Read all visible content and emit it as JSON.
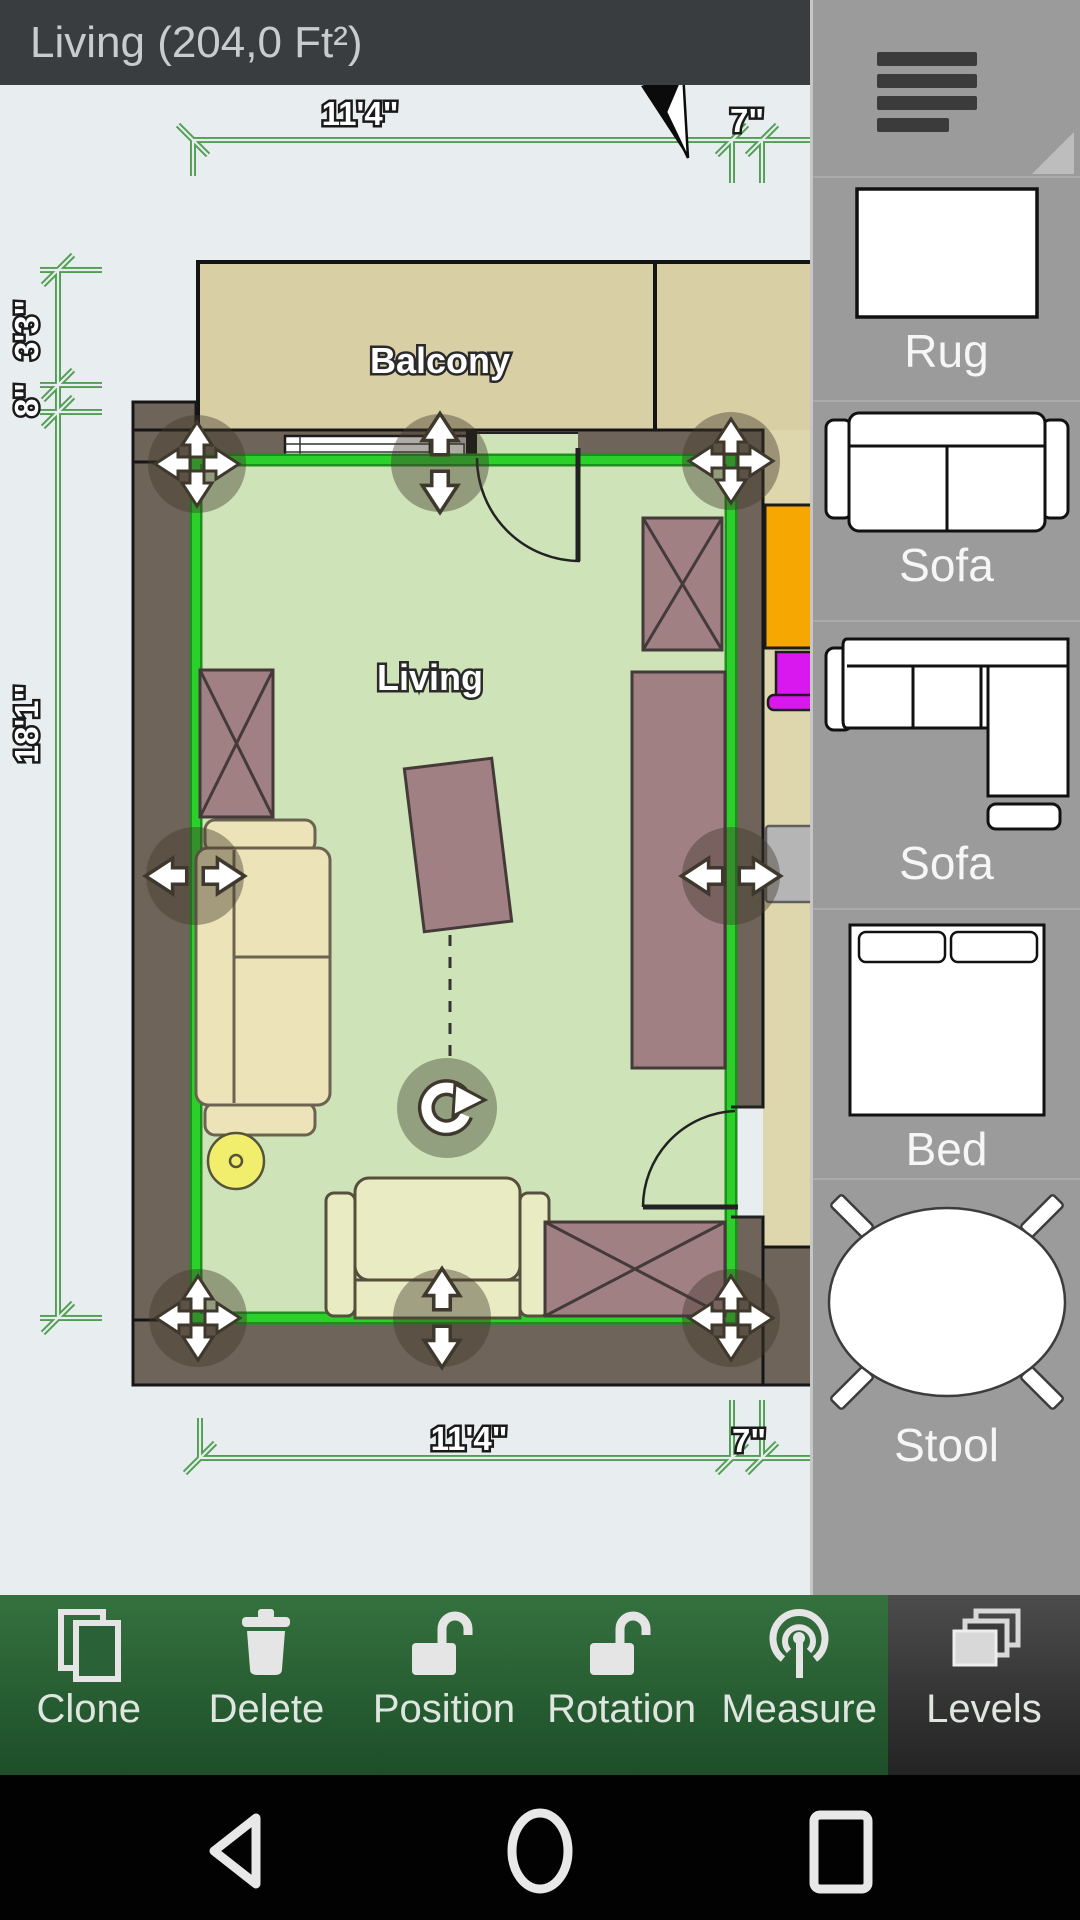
{
  "title_bar": {
    "title": "Living (204,0 Ft²)"
  },
  "plan": {
    "room_label": "Living",
    "balcony_label": "Balcony",
    "dimensions": {
      "top_width": "11'4\"",
      "top_offset": "7\"",
      "bottom_width": "11'4\"",
      "bottom_offset": "7\"",
      "left_balcony": "3'3\"",
      "left_wall": "8\"",
      "left_height": "18'1\""
    }
  },
  "sidebar": {
    "items": [
      {
        "label": "Rug"
      },
      {
        "label": "Sofa"
      },
      {
        "label": "Sofa"
      },
      {
        "label": "Bed"
      },
      {
        "label": "Stool"
      }
    ]
  },
  "toolbar": {
    "buttons": [
      {
        "label": "Clone"
      },
      {
        "label": "Delete"
      },
      {
        "label": "Position"
      },
      {
        "label": "Rotation"
      },
      {
        "label": "Measure"
      },
      {
        "label": "Levels"
      }
    ],
    "active_button": "Levels"
  },
  "colors": {
    "selection_green": "#2bd02b",
    "dimension_green": "#4f9e51",
    "toolbar_green": "#2d6b3a",
    "wall_brown": "#6f6459",
    "room_green": "#cfe3b8",
    "balcony_tan": "#d9cfa5",
    "sidebar_gray": "#9b9b9b",
    "furniture_mauve": "#a08083",
    "sofa_cream": "#ece4b8",
    "accent_orange": "#f7a701",
    "accent_magenta": "#d818ef",
    "stool_yellow": "#f1ee6e"
  }
}
